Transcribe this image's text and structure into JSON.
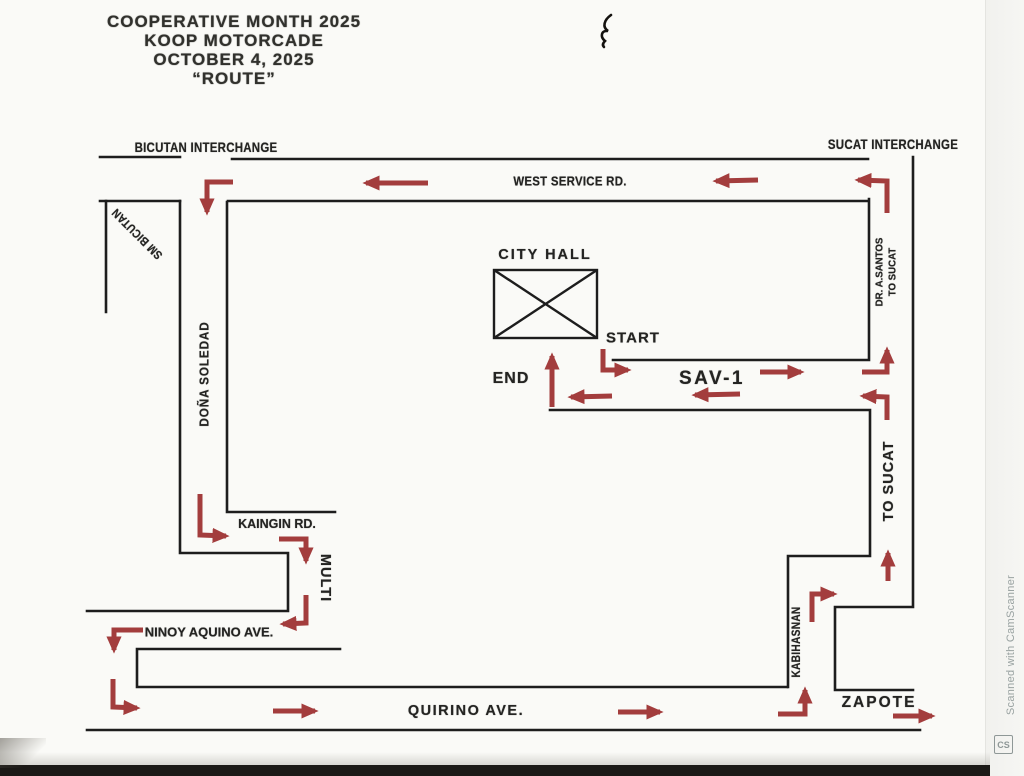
{
  "title": {
    "line1": "COOPERATIVE MONTH 2025",
    "line2": "KOOP MOTORCADE",
    "line3": "OCTOBER 4, 2025",
    "line4": "“ROUTE”"
  },
  "labels": {
    "bicutan_interchange": "BICUTAN INTERCHANGE",
    "sucat_interchange": "SUCAT INTERCHANGE",
    "west_service_rd": "WEST SERVICE RD.",
    "sm_bicutan": "SM BICUTAN",
    "dona_soledad": "DOÑA SOLEDAD",
    "dr_a_santos_1": "DR. A.SANTOS",
    "dr_a_santos_2": "TO SUCAT",
    "city_hall": "CITY HALL",
    "start": "START",
    "end": "END",
    "sav1": "SAV-1",
    "to_sucat": "TO SUCAT",
    "kaingin_rd": "KAINGIN RD.",
    "multi": "MULTI",
    "ninoy_aquino_ave": "NINOY AQUINO AVE.",
    "kabihasnan": "KABIHASNAN",
    "quirino_ave": "QUIRINO AVE.",
    "zapote": "ZAPOTE"
  },
  "route": {
    "start_point": "CITY HALL (START)",
    "end_point": "CITY HALL (END)"
  },
  "watermark": {
    "text": "Scanned with CamScanner",
    "logo": "CS"
  },
  "colors": {
    "arrow": "#a33d3d",
    "road": "#1d1d1d",
    "text": "#242422",
    "watermark": "#9aa3a2"
  }
}
